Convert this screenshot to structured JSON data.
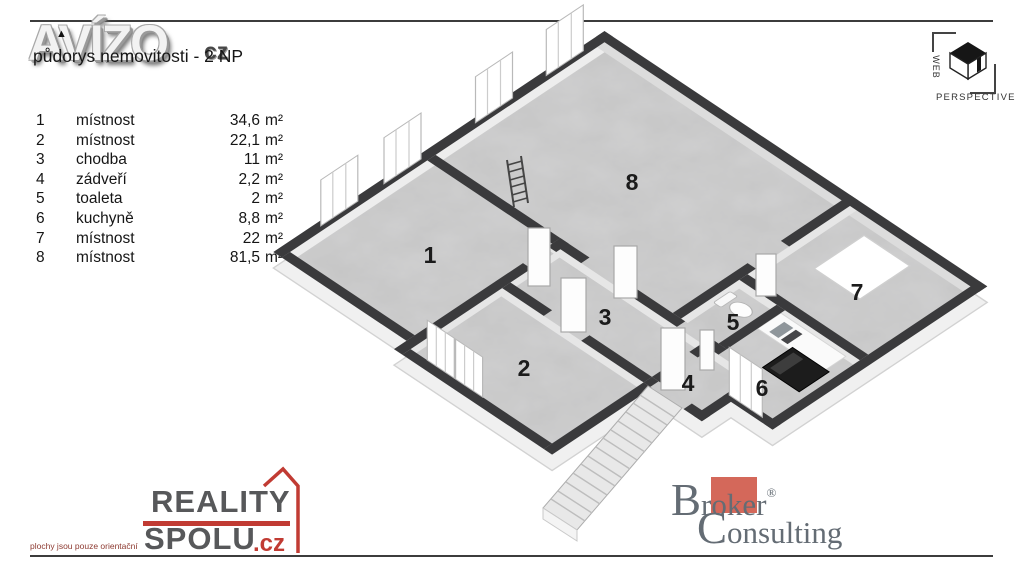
{
  "header": {
    "watermark": "AVÍZO",
    "watermark_suffix": "cz",
    "accent_glyph": "▲",
    "title": "půdorys nemovitosti - 2 NP"
  },
  "legend": {
    "rows": [
      {
        "num": "1",
        "name": "místnost",
        "value": "34,6",
        "unit": "m²"
      },
      {
        "num": "2",
        "name": "místnost",
        "value": "22,1",
        "unit": "m²"
      },
      {
        "num": "3",
        "name": "chodba",
        "value": "11",
        "unit": "m²"
      },
      {
        "num": "4",
        "name": "zádveří",
        "value": "2,2",
        "unit": "m²"
      },
      {
        "num": "5",
        "name": "toaleta",
        "value": "2",
        "unit": "m²"
      },
      {
        "num": "6",
        "name": "kuchyně",
        "value": "8,8",
        "unit": "m²"
      },
      {
        "num": "7",
        "name": "místnost",
        "value": "22",
        "unit": "m²"
      },
      {
        "num": "8",
        "name": "místnost",
        "value": "81,5",
        "unit": "m²"
      }
    ]
  },
  "logos": {
    "web_perspective": {
      "word1": "WEB",
      "word2": "PERSPECTIVE"
    },
    "reality_spolu": {
      "word1": "REALITY",
      "word2": "SPOLU",
      "tld": ".cz",
      "disclaimer": "plochy jsou pouze orientační"
    },
    "broker": {
      "initial1": "B",
      "pre": "r",
      "mid": "ok",
      "post": "er",
      "reg": "®",
      "initial2": "C",
      "rest": "onsulting"
    }
  },
  "colors": {
    "wall": "#3a3a3c",
    "floor": "#c5c5c5",
    "accent_red": "#c13b33",
    "broker_square": "#d4685a"
  }
}
